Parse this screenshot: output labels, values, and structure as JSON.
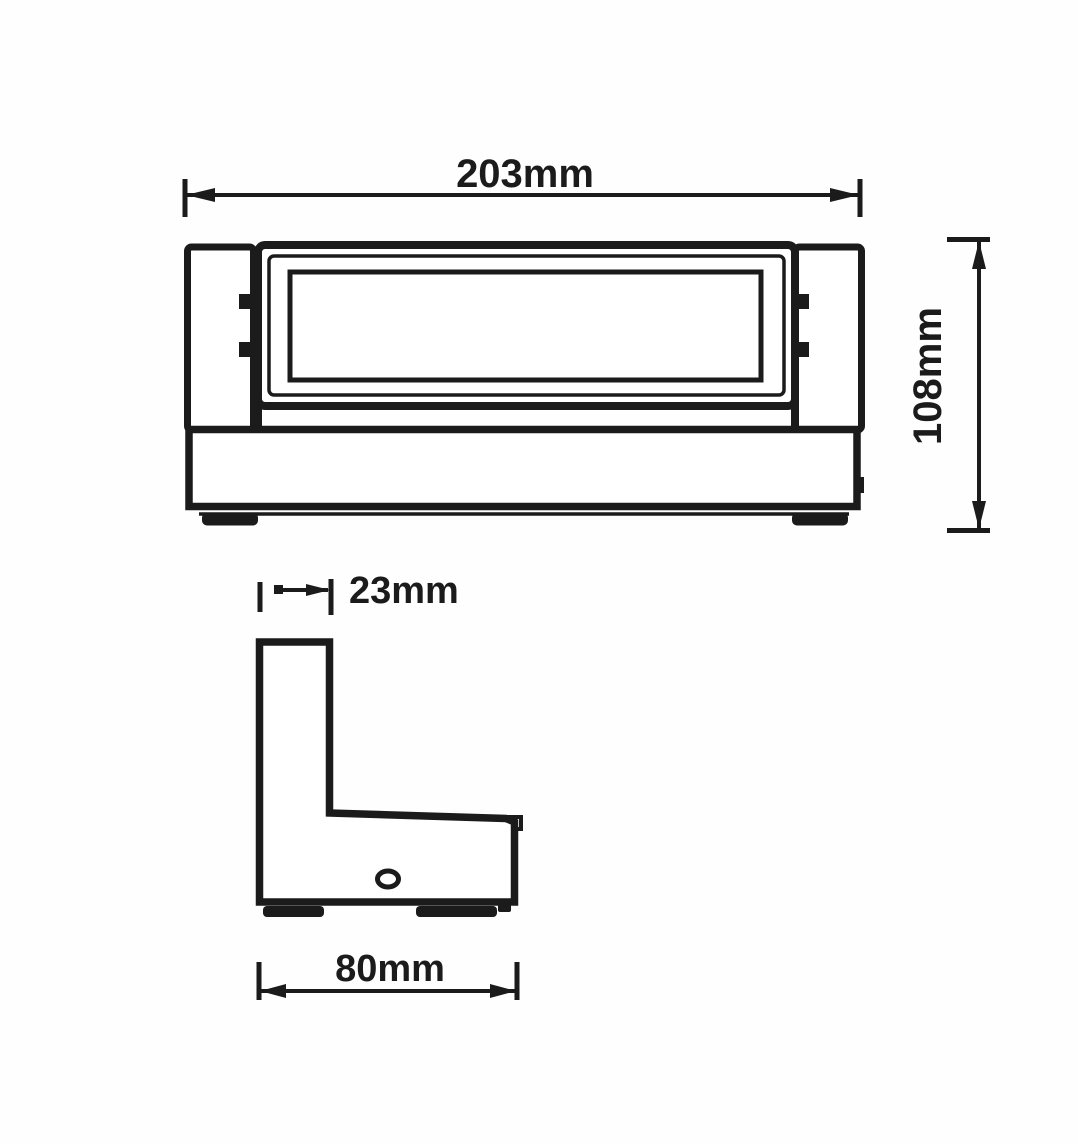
{
  "drawing": {
    "type": "technical-dimension-drawing",
    "colors": {
      "line": "#1b1b1b",
      "background": "#ffffff"
    },
    "dimensions": {
      "front_width": "203mm",
      "front_height": "108mm",
      "side_top_width": "23mm",
      "side_depth": "80mm"
    }
  }
}
